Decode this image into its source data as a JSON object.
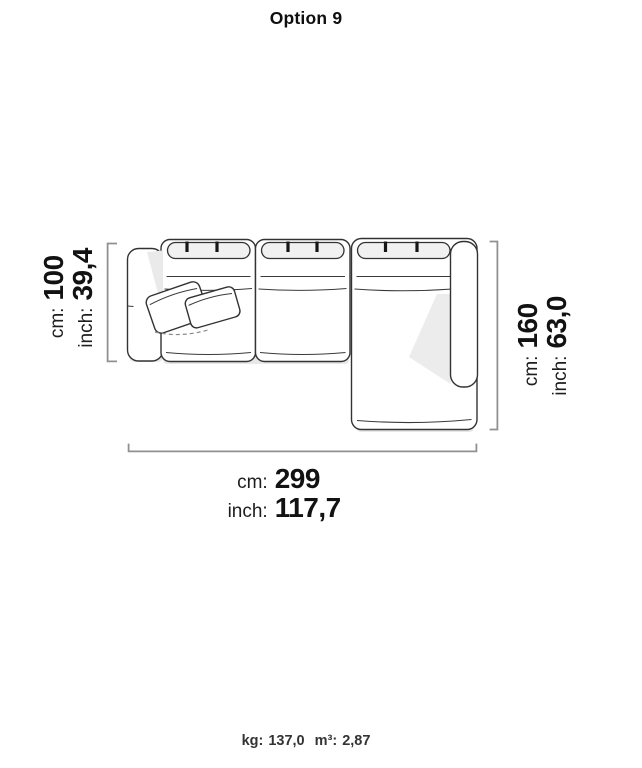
{
  "title": "Option 9",
  "diagram": {
    "name": "sofa-top-view",
    "description": "Top view drawing of a three-module sectional sofa with left armrest, right armrest and right-hand chaise, two throw pillows on the left seat"
  },
  "dimensions": {
    "depth": {
      "unit_cm": "cm:",
      "cm": "100",
      "unit_inch": "inch:",
      "inch": "39,4"
    },
    "chaise_length": {
      "unit_cm": "cm:",
      "cm": "160",
      "unit_inch": "inch:",
      "inch": "63,0"
    },
    "width": {
      "unit_cm": "cm:",
      "cm": "299",
      "unit_inch": "inch:",
      "inch": "117,7"
    }
  },
  "footer": {
    "weight_label": "kg:",
    "weight_value": "137,0",
    "volume_label": "m³:",
    "volume_value": "2,87"
  }
}
